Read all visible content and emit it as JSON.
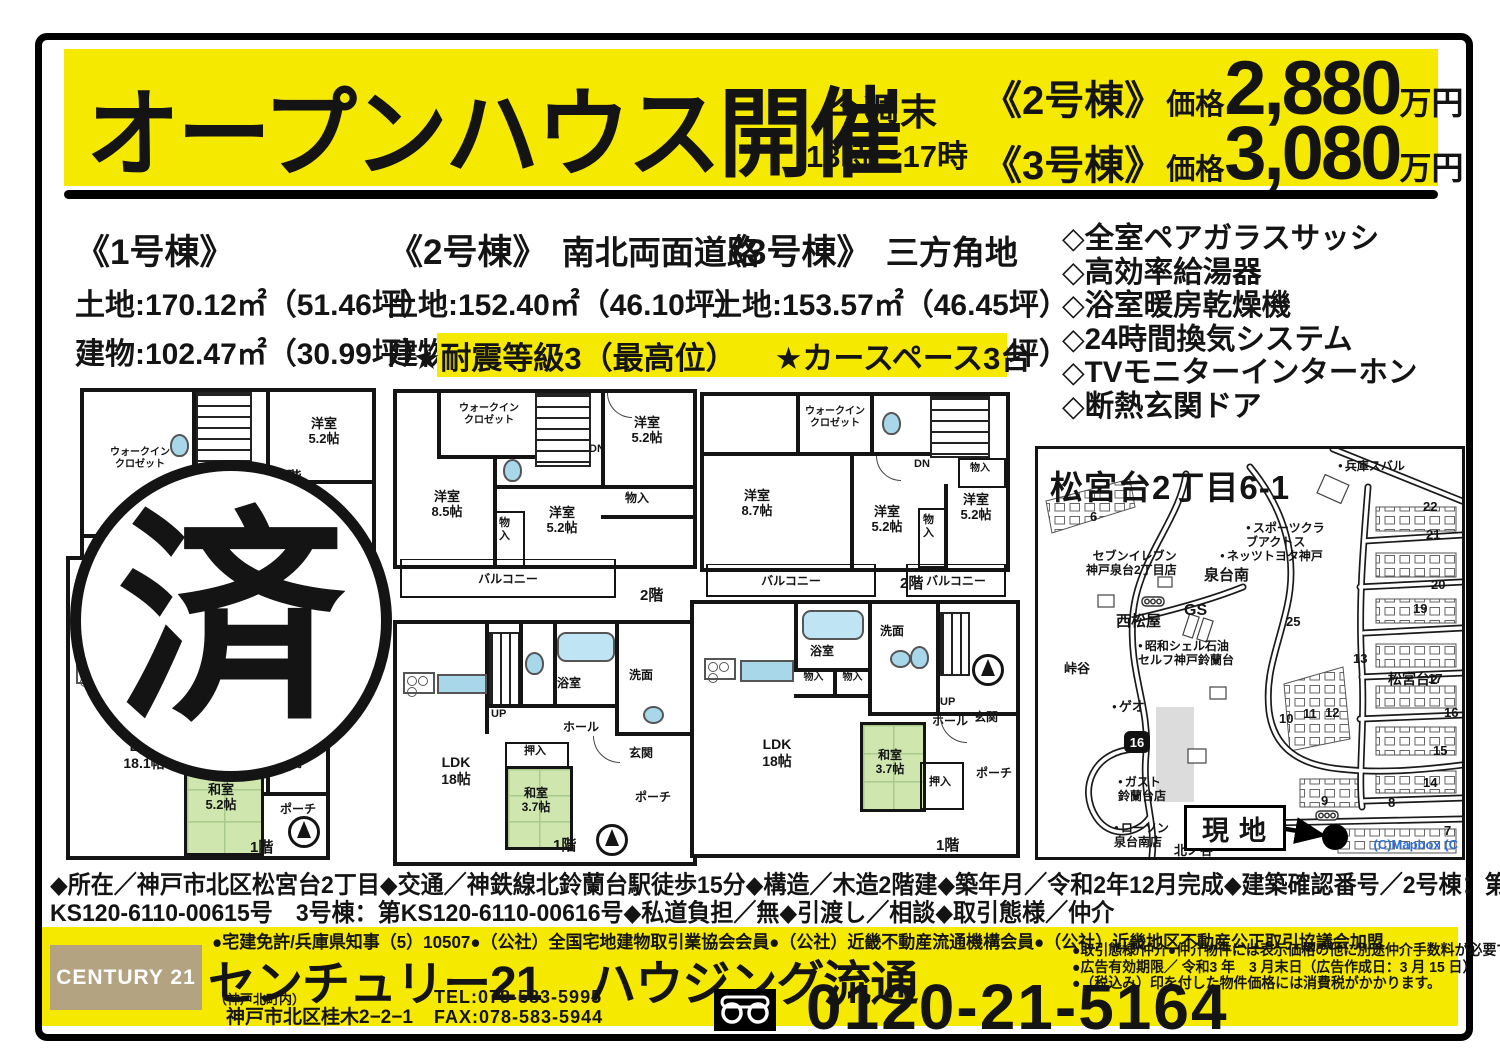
{
  "header": {
    "title": "オープンハウス開催",
    "schedule": {
      "line1": "今週末",
      "line2": "13時〜17時"
    },
    "prices": [
      {
        "building": "《2号棟》",
        "label": "価格",
        "amount": "2,880",
        "unit": "万円"
      },
      {
        "building": "《3号棟》",
        "label": "価格",
        "amount": "3,080",
        "unit": "万円"
      }
    ]
  },
  "buildings": [
    {
      "name": "《1号棟》",
      "feature": "",
      "land": "土地:170.12㎡（51.46坪）",
      "building": "建物:102.47㎡（30.99坪）"
    },
    {
      "name": "《2号棟》",
      "feature": "南北両面道路",
      "land": "土地:152.40㎡（46.10坪）",
      "building": "建物:  99.78㎡（30.18坪）"
    },
    {
      "name": "《3号棟》",
      "feature": "三方角地",
      "land": "土地:153.57㎡（46.45坪）",
      "building": "建物:101.43㎡（30.68坪）"
    }
  ],
  "equipment": [
    "◇全室ペアガラスサッシ",
    "◇高効率給湯器",
    "◇浴室暖房乾燥機",
    "◇24時間換気システム",
    "◇TVモニターインターホン",
    "◇断熱玄関ドア"
  ],
  "highlight": {
    "item1": "★耐震等級3（最高位）",
    "item2": "★カースペース3台"
  },
  "sold_stamp": "済",
  "fp": {
    "b1f2": {
      "wic": "ウォークイン\nクロゼット",
      "dn": "DN",
      "r1": "洋室\n5.2帖",
      "fl": "2階"
    },
    "b1f1": {
      "ldk": "LDK\n18.1帖",
      "oshi": "押入",
      "wa": "和室\n5.2帖",
      "sen": "洗面",
      "hall": "ホール",
      "gen": "玄関",
      "po": "ポーチ",
      "fl": "1階"
    },
    "b2f2": {
      "wic": "ウォークイン\nクロゼット",
      "dn": "DN",
      "r1": "洋室\n5.2帖",
      "r2": "洋室\n8.5帖",
      "m1": "物入",
      "r3": "洋室\n5.2帖",
      "m2": "物\n入",
      "bal": "バルコニー",
      "fl": "2階"
    },
    "b2f1": {
      "ldk": "LDK\n18帖",
      "up": "UP",
      "bath": "浴室",
      "sen": "洗面",
      "hall": "ホール",
      "oshi": "押入",
      "wa": "和室\n3.7帖",
      "gen": "玄関",
      "po": "ポーチ",
      "fl": "1階"
    },
    "b3f2": {
      "wic": "ウォークイン\nクロゼット",
      "dn": "DN",
      "m1": "物入",
      "r1": "洋室\n8.7帖",
      "r2": "洋室\n5.2帖",
      "m2": "物\n入",
      "r3": "洋室\n5.2帖",
      "bal1": "バルコニー",
      "bal2": "バルコニー",
      "fl": "2階"
    },
    "b3f1": {
      "ldk": "LDK\n18帖",
      "bath": "浴室",
      "sen": "洗面",
      "m1": "物入",
      "m2": "物入",
      "up": "UP",
      "hall": "ホール",
      "gen": "玄関",
      "wa": "和室\n3.7帖",
      "oshi": "押入",
      "po": "ポーチ",
      "fl": "1階"
    }
  },
  "map": {
    "title": "松宮台2丁目6-1",
    "site": "現地",
    "route_badge": "16",
    "copyright": "(C)Mapbox  (C",
    "pois": [
      {
        "text": "兵庫スバル"
      },
      {
        "text": "スポーツクラ\nブアクトス"
      },
      {
        "text": "ネッツトヨタ神戸"
      },
      {
        "text": "セブンイレブン\n神戸泉台2丁目店"
      },
      {
        "text": "泉台南"
      },
      {
        "text": "GS"
      },
      {
        "text": "西松屋"
      },
      {
        "text": "昭和シェル石油\nセルフ神戸鈴蘭台"
      },
      {
        "text": "峠谷"
      },
      {
        "text": "ゲオ"
      },
      {
        "text": "ガスト\n鈴蘭台店"
      },
      {
        "text": "ローソン\n泉台南店"
      },
      {
        "text": "北ノ谷"
      },
      {
        "text": "松宮台2"
      }
    ],
    "blocks": [
      "6",
      "22",
      "21",
      "20",
      "25",
      "19",
      "13",
      "17",
      "10",
      "11",
      "12",
      "16",
      "15",
      "14",
      "9",
      "8",
      "7"
    ]
  },
  "details": {
    "line1": "◆所在／神戸市北区松宮台2丁目◆交通／神鉄線北鈴蘭台駅徒歩15分◆構造／木造2階建◆築年月／令和2年12月完成◆建築確認番号／2号棟：第",
    "line2": "KS120-6110-00615号　3号棟：第KS120-6110-00616号◆私道負担／無◆引渡し／相談◆取引態様／仲介"
  },
  "footer": {
    "license": "●宅建免許/兵庫県知事（5）10507●（公社）全国宅地建物取引業協会会員●（公社）近畿不動産流通機構会員●（公社）近畿地区不動産公正取引協議会加盟",
    "logo": "CENTURY 21",
    "company": "センチュリー21　ハウジング流通",
    "branch_note": "（神戸北町内）",
    "address": "神戸市北区桂木2−2−1",
    "tel": "TEL:078-583-5995",
    "fax": "FAX:078-583-5944",
    "freedial": "0120-21-5164",
    "notes": [
      "●取引態様/仲介●仲介物件には表示価格の他に別途仲介手数料が必要です。",
      "●広告有効期限／ 令和3 年　3 月末日（広告作成日：3 月 15 日）",
      "●（税込み）印を付した物件価格には消費税がかかります。"
    ]
  }
}
